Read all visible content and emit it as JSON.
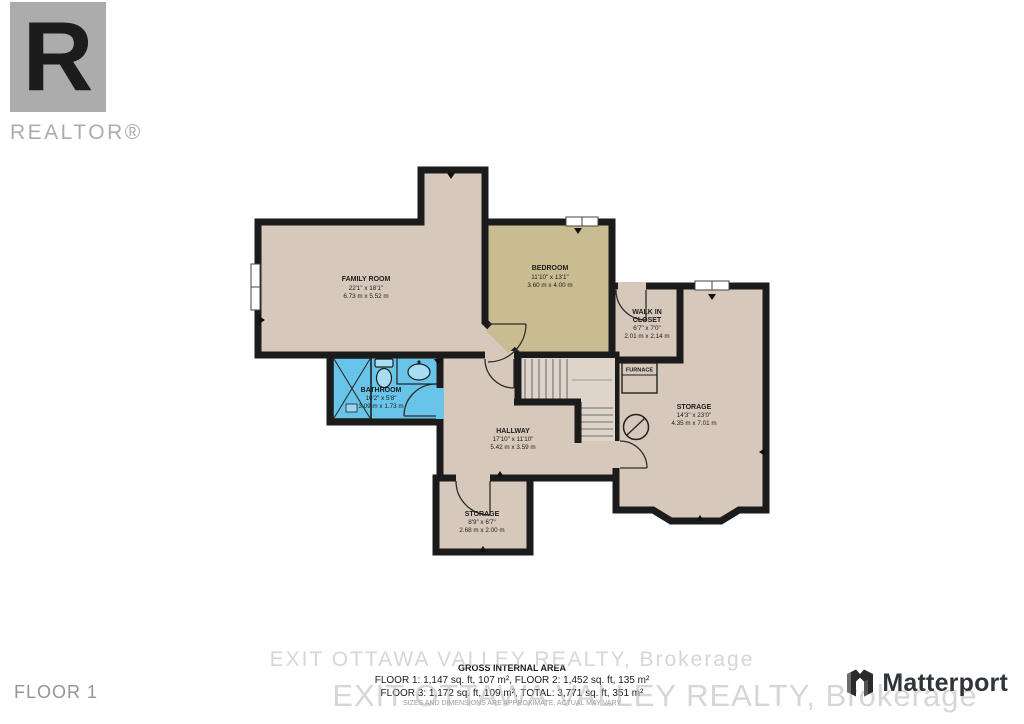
{
  "branding": {
    "realtor_wordmark": "REALTOR®",
    "realtor_glyph": "R",
    "matterport_wordmark": "Matterport"
  },
  "floor_label": "FLOOR 1",
  "watermark": {
    "text": "EXIT OTTAWA VALLEY REALTY, Brokerage"
  },
  "footer": {
    "title": "GROSS INTERNAL AREA",
    "line1": "FLOOR 1: 1,147 sq. ft, 107 m²,  FLOOR 2: 1,452 sq. ft, 135 m²",
    "line2": "FLOOR 3: 1,172 sq. ft, 109 m², TOTAL: 3,771 sq. ft, 351 m²",
    "disclaimer": "SIZES AND DIMENSIONS ARE APPROXIMATE, ACTUAL MAY VARY"
  },
  "rooms": {
    "family_room": {
      "name": "FAMILY ROOM",
      "dims_ft": "22'1\" x 18'1\"",
      "dims_m": "6.73 m x 5.52 m"
    },
    "bedroom": {
      "name": "BEDROOM",
      "dims_ft": "11'10\" x 13'1\"",
      "dims_m": "3.60 m x 4.00 m"
    },
    "walk_in_closet": {
      "name_line1": "WALK IN",
      "name_line2": "CLOSET",
      "dims_ft": "6'7\" x 7'0\"",
      "dims_m": "2.01 m x 2.14 m"
    },
    "bathroom": {
      "name": "BATHROOM",
      "dims_ft": "10'2\" x 5'8\"",
      "dims_m": "3.09 m x 1.73 m"
    },
    "hallway": {
      "name": "HALLWAY",
      "dims_ft": "17'10\" x 11'10\"",
      "dims_m": "5.42 m x 3.59 m"
    },
    "storage_large": {
      "name": "STORAGE",
      "dims_ft": "14'3\" x 23'0\"",
      "dims_m": "4.35 m x 7.01 m"
    },
    "storage_small": {
      "name": "STORAGE",
      "dims_ft": "8'9\" x 6'7\"",
      "dims_m": "2.68 m x 2.00 m"
    },
    "furnace": {
      "name": "FURNACE"
    }
  },
  "colors": {
    "wall": "#1b1b1b",
    "floor_beige": "#d7c8bc",
    "bedroom_olive": "#c9bc90",
    "bathroom_blue": "#68c4e9",
    "stairs_fill": "#ded4ca",
    "logo_gray": "#acacac"
  }
}
